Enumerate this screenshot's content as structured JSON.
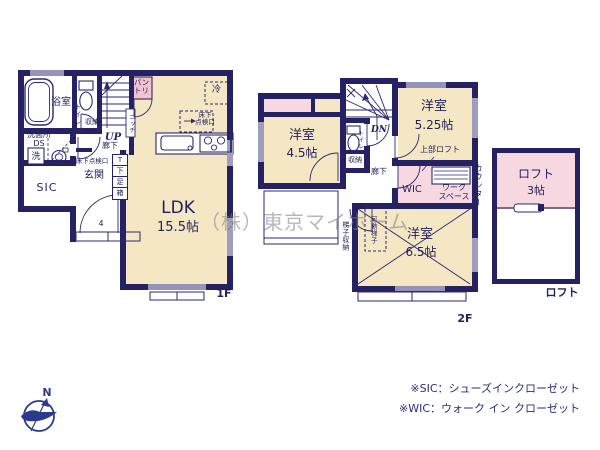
{
  "watermark": "（株）東京マイホーム",
  "compass": {
    "north": "N"
  },
  "floor1": {
    "floor_label": "1F",
    "bath": "浴室",
    "toilet": "トイレ",
    "toilet_storage": "収納",
    "washroom": "洗面所\nDS",
    "washer": "洗",
    "up": "UP",
    "hallway": "廊下",
    "underfloor_hatch": "床下点検口",
    "entrance": "玄関",
    "shoe_box_cells": [
      "T",
      "下",
      "足",
      "箱"
    ],
    "sic": "SIC",
    "pantry": "パン\nトリー",
    "niche": "ニッチ",
    "fridge": "冷",
    "underfloor_hatch_kitchen": "床下\n点検口",
    "ldk_name": "LDK",
    "ldk_size": "15.5帖",
    "porch_steps": "4"
  },
  "floor2": {
    "floor_label": "2F",
    "room_a_name": "洋室",
    "room_a_size": "4.5帖",
    "room_b_name": "洋室",
    "room_b_size": "5.25帖",
    "room_c_name": "洋室",
    "room_c_size": "6.5帖",
    "dn": "DN",
    "toilet": "トイレ",
    "storage": "収納",
    "hallway": "廊下",
    "upper_loft": "上部ロフト",
    "wic": "WIC",
    "workspace": "ワーク\nスペース",
    "counter": "カウンター",
    "movable_ladder": "可動梯子",
    "ladder_storage": "梯子収納"
  },
  "loft": {
    "name": "ロフト",
    "size": "3帖",
    "floor_label": "ロフト"
  },
  "notes": {
    "sic": "※SIC：シューズインクローゼット",
    "wic": "※WIC：ウォーク イン クローゼット"
  },
  "colors": {
    "wall": "#252263",
    "room_beige": "#f5e7c3",
    "room_pink": "#f7d8e0",
    "pantry_pink": "#f4c3cf",
    "text_navy": "#23215e"
  }
}
